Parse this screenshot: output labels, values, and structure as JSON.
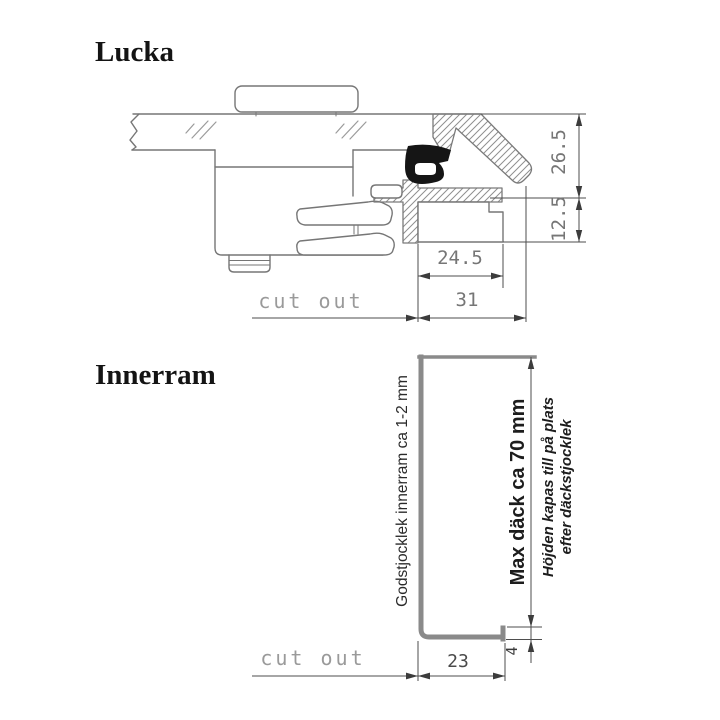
{
  "colors": {
    "background": "#ffffff",
    "drawing_line_gray": "#767676",
    "dimension_line_dark": "#4e4e4e",
    "dimension_text_gray": "#767676",
    "cutout_text_gray": "#9a9a9a",
    "seal_black": "#151515",
    "profile_gray": "#8a8a8a",
    "title_black": "#141414"
  },
  "lucka": {
    "title": "Lucka",
    "cutout_label": "cut out",
    "dims": {
      "frame_height_upper": "26.5",
      "frame_height_lower": "12.5",
      "flange_width": "24.5",
      "frame_width": "31"
    }
  },
  "innerram": {
    "title": "Innerram",
    "cutout_label": "cut out",
    "dims": {
      "base_width": "23",
      "lip_height": "4"
    },
    "labels": {
      "material_thickness": "Godstjocklek innerram ca 1-2 mm",
      "max_deck": "Max däck ca 70 mm",
      "height_note_line1": "Höjden kapas till på plats",
      "height_note_line2": "efter däckstjocklek"
    }
  }
}
